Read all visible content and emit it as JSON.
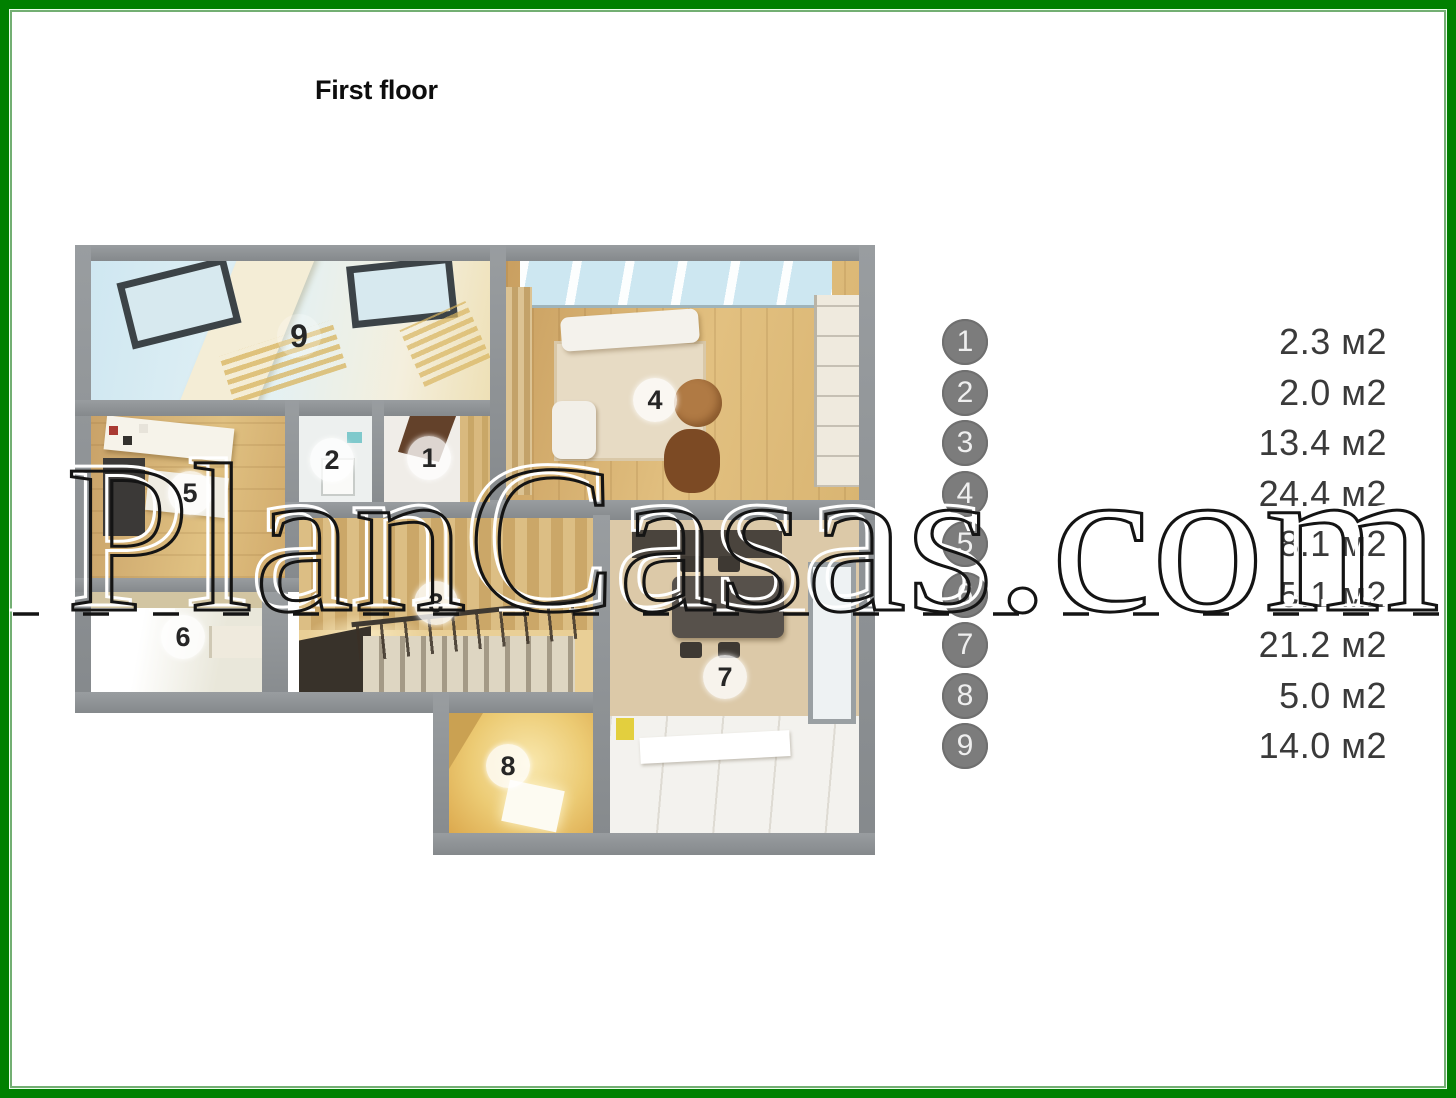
{
  "page": {
    "title": "First floor",
    "watermark": "PlanCasas.com"
  },
  "colors": {
    "frame_green": "#008000",
    "wall_gray": "#8d9194",
    "legend_circle_gray": "#7c7c7c",
    "legend_text": "#3a3a3a"
  },
  "plan": {
    "badges": [
      "1",
      "2",
      "3",
      "4",
      "5",
      "6",
      "7",
      "8",
      "9"
    ]
  },
  "legend": {
    "items": [
      {
        "number": "1",
        "area": "2.3 м2"
      },
      {
        "number": "2",
        "area": "2.0 м2"
      },
      {
        "number": "3",
        "area": "13.4 м2"
      },
      {
        "number": "4",
        "area": "24.4 м2"
      },
      {
        "number": "5",
        "area": "8.1 м2"
      },
      {
        "number": "6",
        "area": "5.1 м2"
      },
      {
        "number": "7",
        "area": "21.2 м2"
      },
      {
        "number": "8",
        "area": "5.0 м2"
      },
      {
        "number": "9",
        "area": "14.0 м2"
      }
    ]
  }
}
